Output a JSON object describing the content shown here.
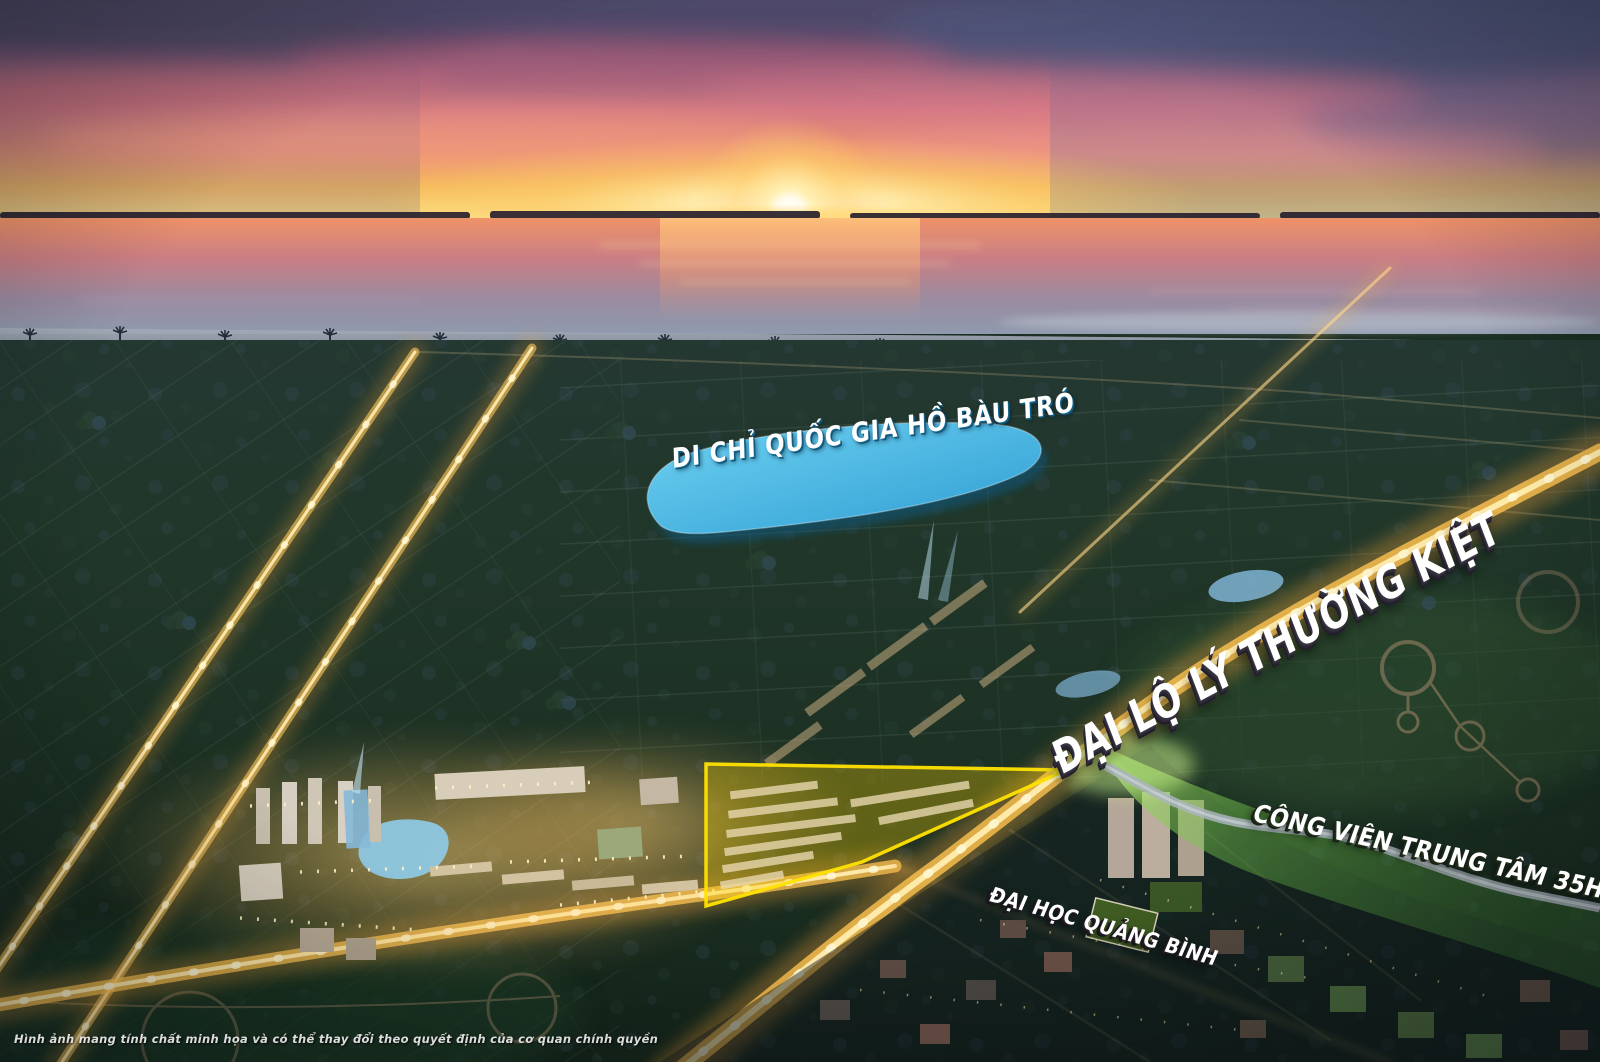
{
  "scene": {
    "kind": "aerial-sunset-masterplan-render",
    "labels": {
      "lake": "DI CHỈ QUỐC GIA HỒ BÀU TRÓ",
      "boulevard": "ĐẠI LỘ LÝ THƯỜNG KIỆT",
      "park": "CÔNG VIÊN TRUNG TÂM 35HA",
      "university": "ĐẠI HỌC QUẢNG BÌNH",
      "disclaimer": "Hình ảnh mang tính chất minh họa và có thể thay đổi theo quyết định của cơ quan chính quyền"
    },
    "highlights": {
      "lake_fill": "#3db4e6",
      "parcel_outline": "#ffd900",
      "park_band": "#63bf45",
      "road_glow": "#ffc24a",
      "sun_core": "#fff6d8",
      "sky_top": "#4c4a68",
      "ocean_bottom": "#8f9aae"
    }
  }
}
